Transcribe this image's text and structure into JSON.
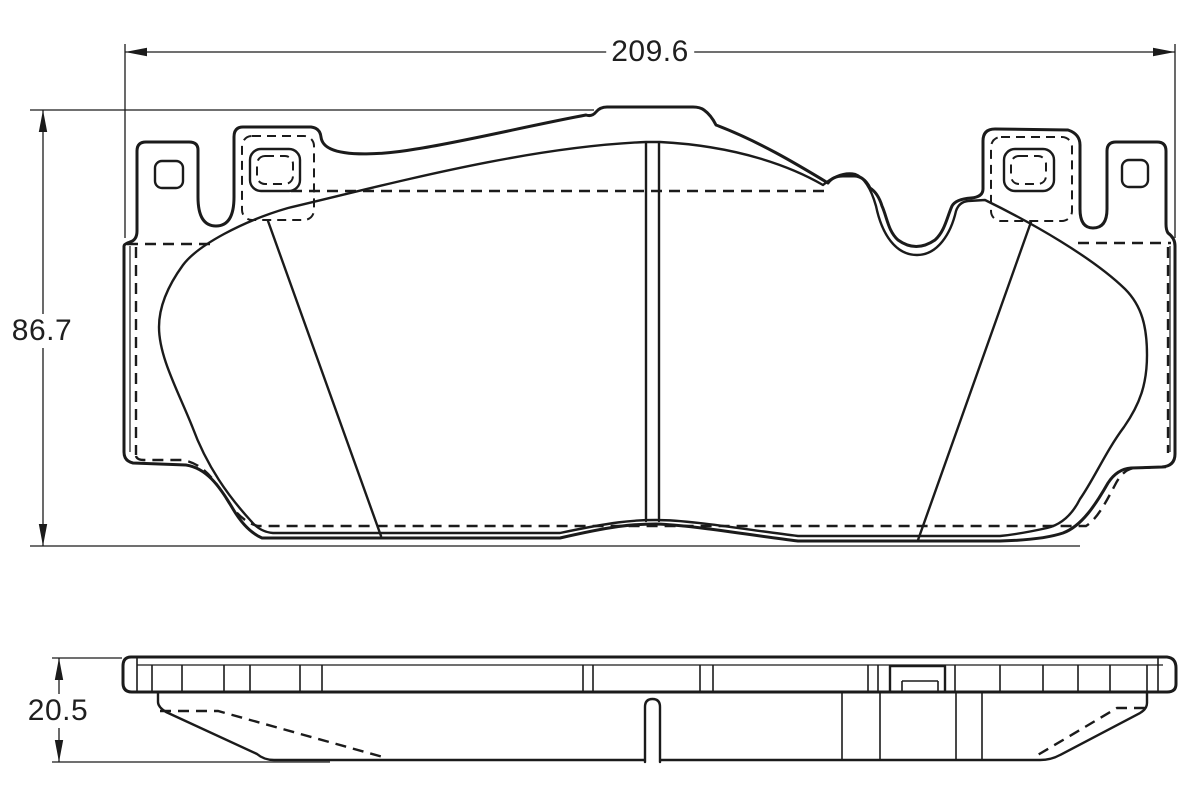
{
  "drawing": {
    "title": "brake-pad-technical-drawing",
    "dimensions": {
      "overall_width_mm": "209.6",
      "overall_height_mm": "86.7",
      "overall_thickness_mm": "20.5"
    },
    "colors": {
      "friction_material": "#f6c5a8",
      "line": "#1b1b1b",
      "background": "#ffffff"
    }
  }
}
